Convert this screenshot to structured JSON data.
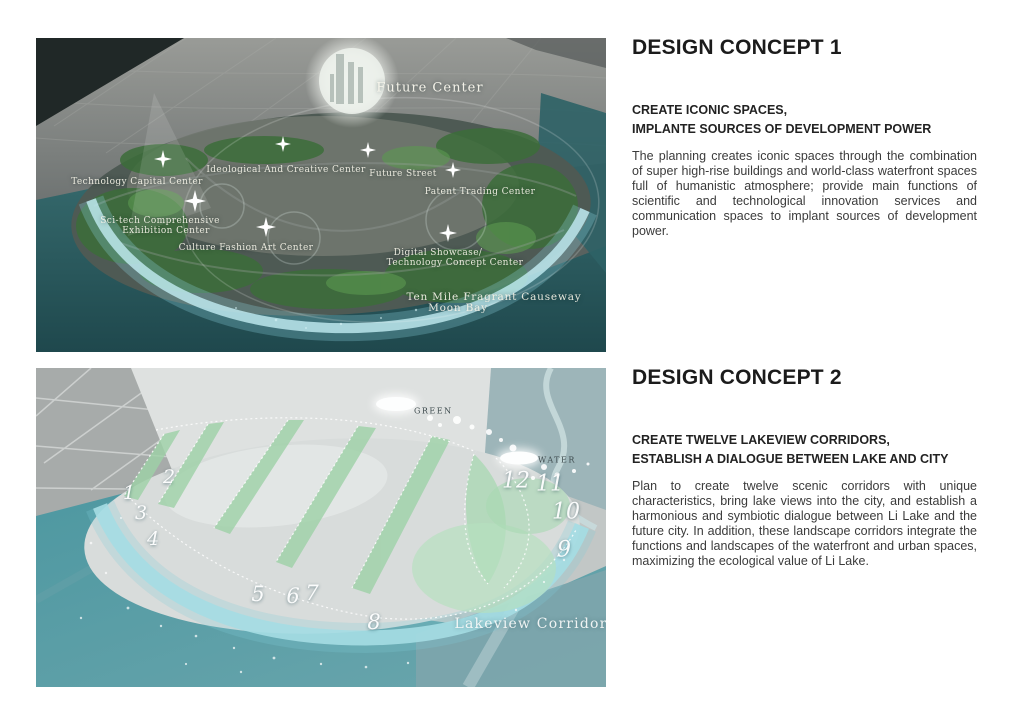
{
  "icons": {
    "sparkle": "four-point-star"
  },
  "colors": {
    "title_text": "#1b1b1b",
    "body_text": "#3b3b3b",
    "map1_water": "#2e6164",
    "map1_shore": "#c3eef4",
    "map2_water": "#4e98a1",
    "map2_green": "#9ed2a7",
    "map_label_text": "#f6f4e8",
    "legend_text": "#3e4b4e"
  },
  "sections": [
    {
      "title": "DESIGN CONCEPT 1",
      "subtitle_line1": "CREATE ICONIC SPACES,",
      "subtitle_line2": "IMPLANTE SOURCES OF DEVELOPMENT POWER",
      "body": "The planning creates iconic spaces through the combination of super high-rise buildings and world-class waterfront spaces full of humanistic atmosphere; provide main functions of scientific and technological innovation services and communication spaces to implant sources of development power.",
      "map": {
        "labels": [
          {
            "text": "Future Center"
          },
          {
            "text": "Technology Capital Center"
          },
          {
            "text": "Ideological And Creative Center"
          },
          {
            "text": "Future Street"
          },
          {
            "text": "Patent Trading Center"
          },
          {
            "text": "Sci-tech Comprehensive"
          },
          {
            "text": "Exhibition Center"
          },
          {
            "text": "Culture Fashion Art Center"
          },
          {
            "text": "Digital Showcase/"
          },
          {
            "text": "Technology Concept Center"
          },
          {
            "text": "Ten Mile Fragrant Causeway"
          },
          {
            "text": "Moon Bay"
          }
        ]
      }
    },
    {
      "title": "DESIGN CONCEPT 2",
      "subtitle_line1": "CREATE TWELVE LAKEVIEW CORRIDORS,",
      "subtitle_line2": "ESTABLISH A DIALOGUE BETWEEN LAKE AND CITY",
      "body": "Plan to create twelve scenic corridors with unique characteristics, bring lake views into the city, and establish a harmonious and symbiotic dialogue between Li Lake and the future city. In addition, these landscape corridors integrate the functions and landscapes of the waterfront and urban spaces, maximizing the ecological value of Li Lake.",
      "map": {
        "legend": [
          {
            "label": "GREEN"
          },
          {
            "label": "WATER"
          }
        ],
        "numbers": [
          "1",
          "2",
          "3",
          "4",
          "5",
          "6",
          "7",
          "8",
          "9",
          "10",
          "11",
          "12"
        ],
        "caption": "Lakeview Corridor"
      }
    }
  ]
}
